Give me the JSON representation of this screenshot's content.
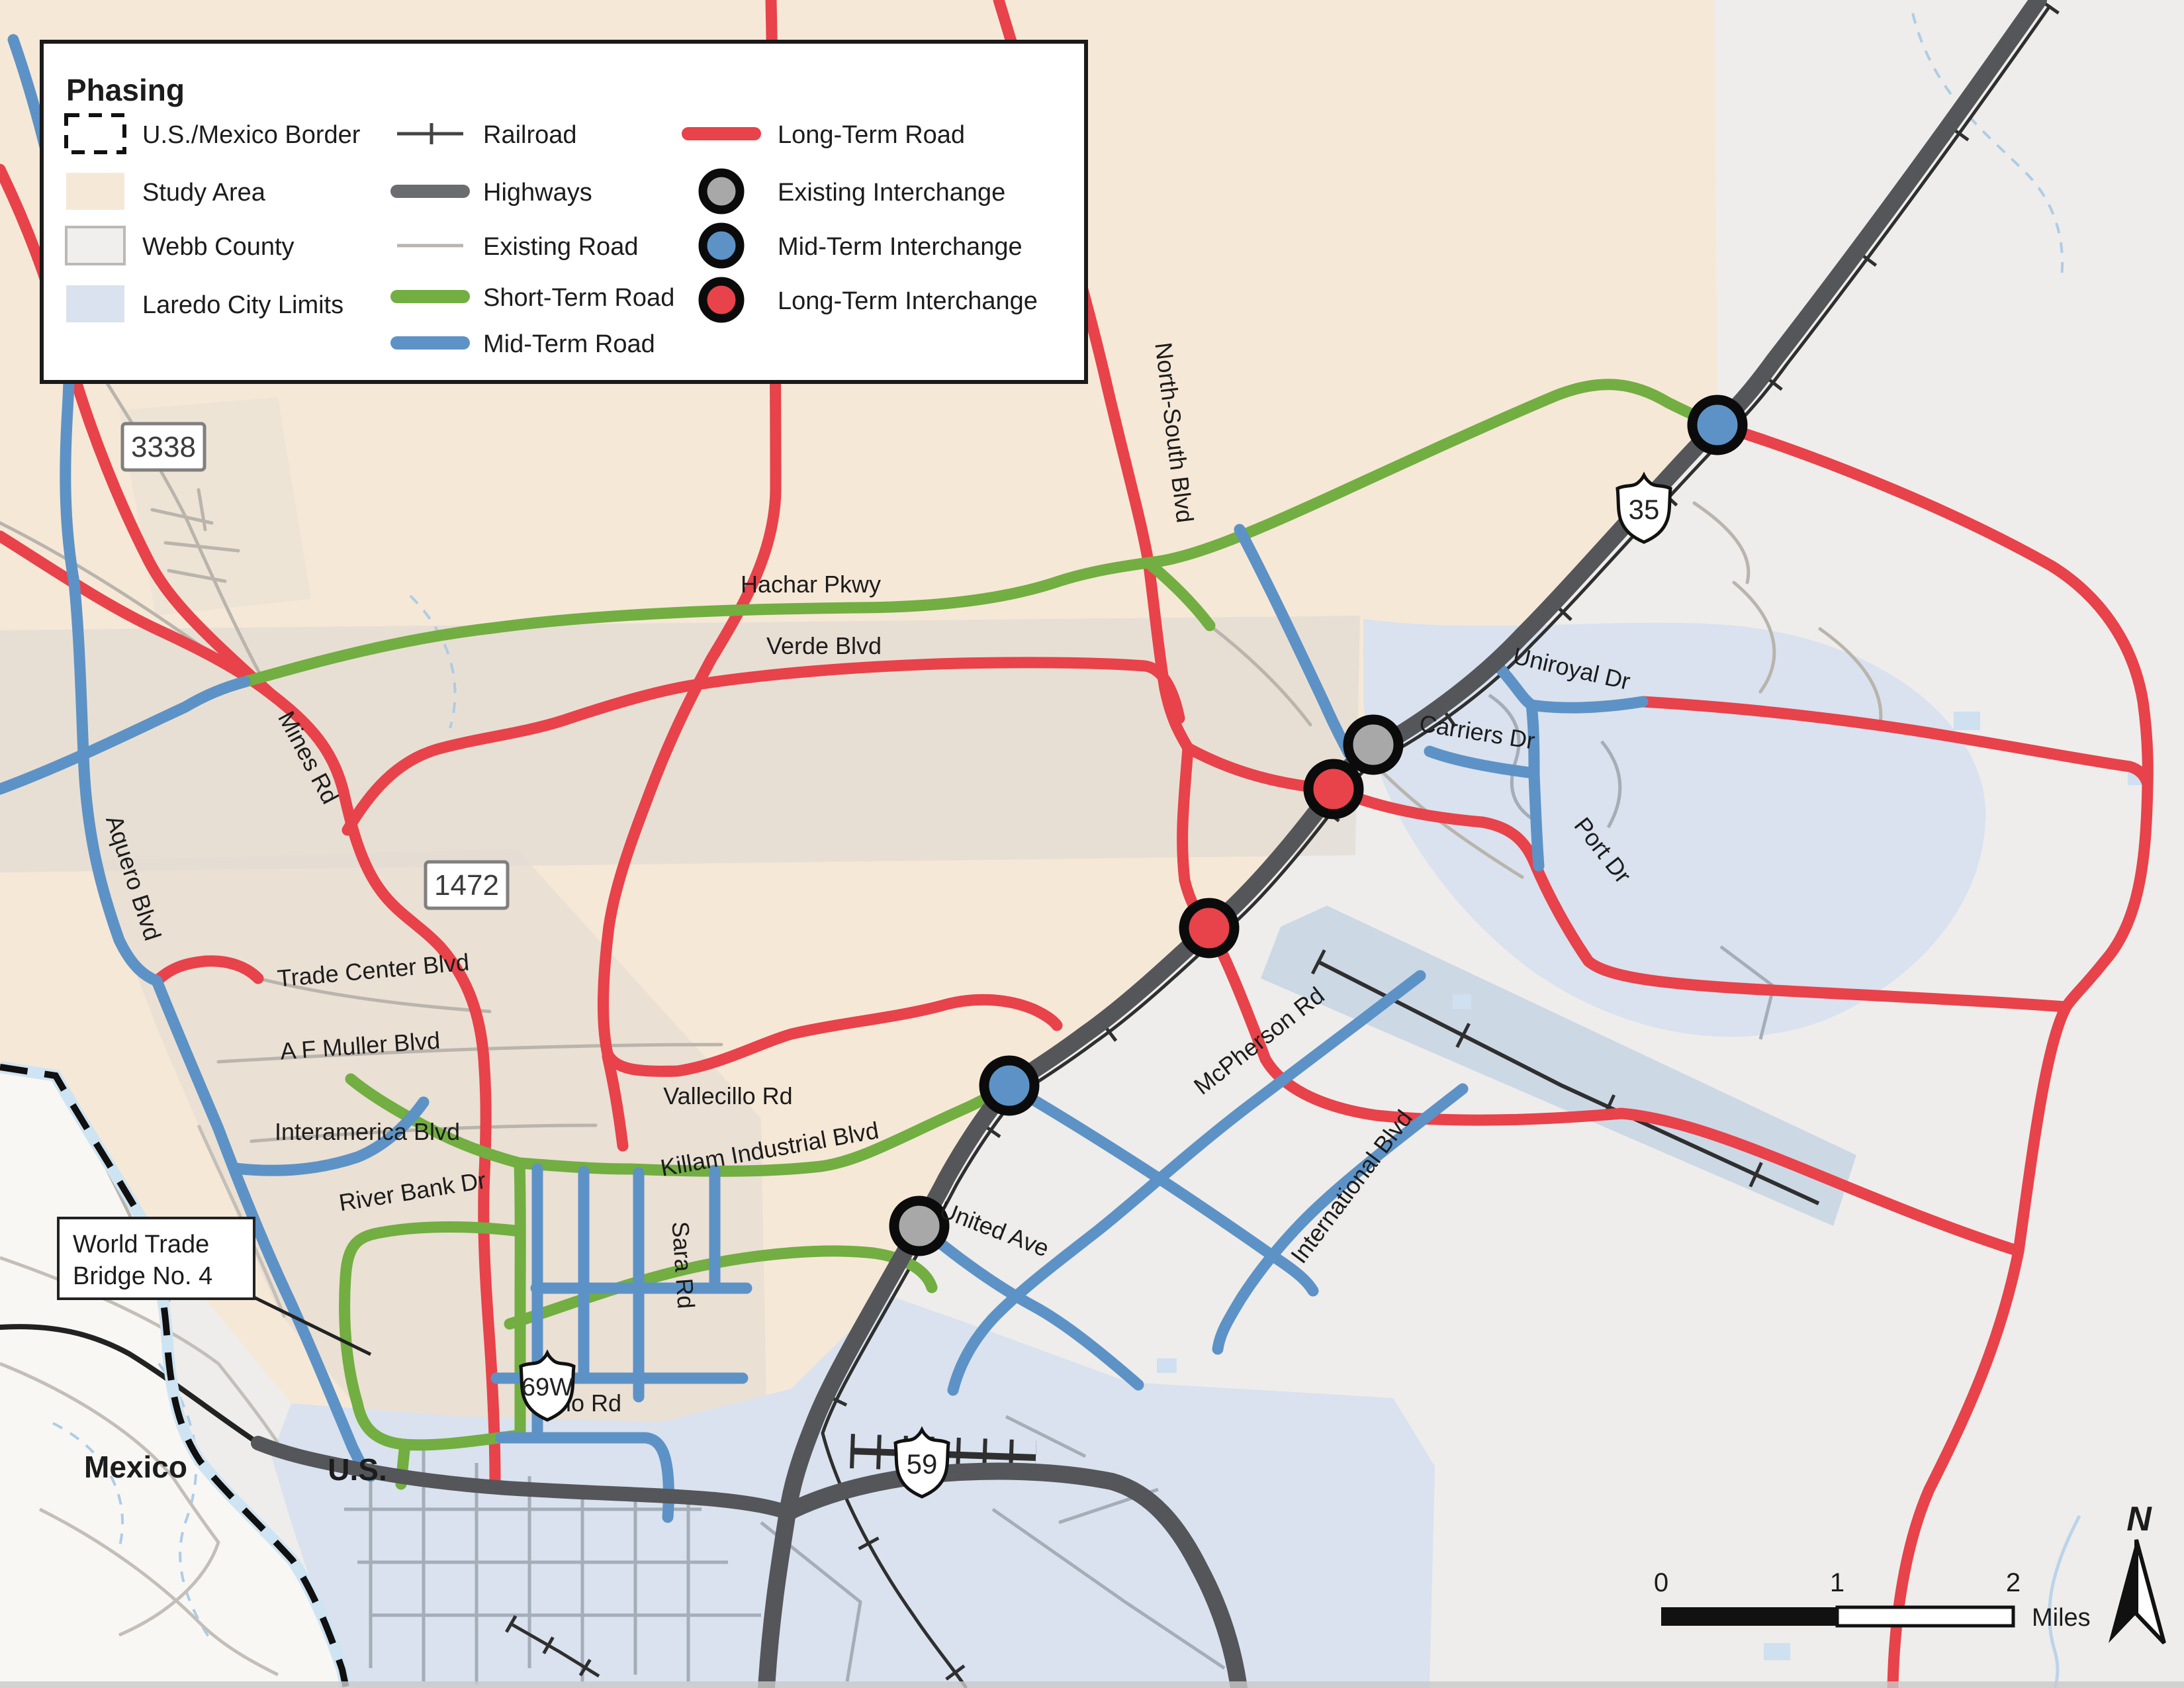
{
  "legend": {
    "title": "Phasing",
    "areas": [
      {
        "label": "U.S./Mexico Border",
        "swatch": "dashed-border",
        "color": "#111111"
      },
      {
        "label": "Study Area",
        "swatch": "fill",
        "color": "#f6e8d7"
      },
      {
        "label": "Webb County",
        "swatch": "fill-border",
        "color": "#f0efed",
        "border": "#b9b9b9"
      },
      {
        "label": "Laredo City Limits",
        "swatch": "fill",
        "color": "#d9e2ee"
      }
    ],
    "lines": [
      {
        "label": "Railroad",
        "swatch": "railroad",
        "color": "#3a3a3a"
      },
      {
        "label": "Highways",
        "swatch": "line-thick",
        "color": "#6b6c70"
      },
      {
        "label": "Existing Road",
        "swatch": "line-thin",
        "color": "#b9b4ac"
      },
      {
        "label": "Short-Term Road",
        "swatch": "line-thick",
        "color": "#72ae41"
      },
      {
        "label": "Mid-Term Road",
        "swatch": "line-thick",
        "color": "#5d92c6"
      }
    ],
    "phasing": [
      {
        "label": "Long-Term Road",
        "swatch": "line-thick",
        "color": "#e8424a"
      },
      {
        "label": "Existing Interchange",
        "swatch": "circle",
        "color": "#a8a8a8"
      },
      {
        "label": "Mid-Term Interchange",
        "swatch": "circle",
        "color": "#5d92c6"
      },
      {
        "label": "Long-Term Interchange",
        "swatch": "circle",
        "color": "#e8424a"
      }
    ]
  },
  "shields": [
    {
      "text": "3338",
      "type": "rect"
    },
    {
      "text": "1472",
      "type": "rect"
    },
    {
      "text": "35",
      "type": "us"
    },
    {
      "text": "69W",
      "type": "us"
    },
    {
      "text": "59",
      "type": "us"
    }
  ],
  "road_labels": [
    {
      "text": "Mines Rd"
    },
    {
      "text": "Aquero Blvd"
    },
    {
      "text": "Hachar Pkwy"
    },
    {
      "text": "Verde Blvd"
    },
    {
      "text": "North-South Blvd"
    },
    {
      "text": "Trade Center Blvd"
    },
    {
      "text": "A F Muller Blvd"
    },
    {
      "text": "Interamerica Blvd"
    },
    {
      "text": "River Bank Dr"
    },
    {
      "text": "Killam Industrial Blvd"
    },
    {
      "text": "Vallecillo Rd"
    },
    {
      "text": "Sara Rd"
    },
    {
      "text": "Milo Rd"
    },
    {
      "text": "United Ave"
    },
    {
      "text": "McPherson Rd"
    },
    {
      "text": "International Blvd"
    },
    {
      "text": "Uniroyal Dr"
    },
    {
      "text": "Carriers Dr"
    },
    {
      "text": "Port Dr"
    }
  ],
  "region_labels": [
    {
      "text": "Mexico"
    },
    {
      "text": "U.S."
    }
  ],
  "callout": {
    "line1": "World Trade",
    "line2": "Bridge No. 4"
  },
  "scale_bar": {
    "ticks": [
      "0",
      "1",
      "2"
    ],
    "unit": "Miles"
  },
  "north_arrow": {
    "label": "N"
  },
  "interchanges": [
    {
      "name": "mid-term-interchange-i35-north",
      "color": "#5d92c6"
    },
    {
      "name": "existing-interchange-carriers",
      "color": "#a8a8a8"
    },
    {
      "name": "long-term-interchange-north",
      "color": "#e8424a"
    },
    {
      "name": "long-term-interchange-south",
      "color": "#e8424a"
    },
    {
      "name": "mid-term-interchange-vallecillo",
      "color": "#5d92c6"
    },
    {
      "name": "existing-interchange-united",
      "color": "#a8a8a8"
    }
  ],
  "colors": {
    "long_term_road": "#e8424a",
    "short_term_road": "#72ae41",
    "mid_term_road": "#5d92c6",
    "highway": "#55565a",
    "existing_road": "#b9b4ac",
    "railroad": "#2f2f2f",
    "study_area": "#f6e8d7",
    "webb_county": "#eeedeb",
    "laredo_city": "#d9e2ee",
    "mexico_land": "#f8f7f4",
    "border_river": "#cfe4f2"
  }
}
